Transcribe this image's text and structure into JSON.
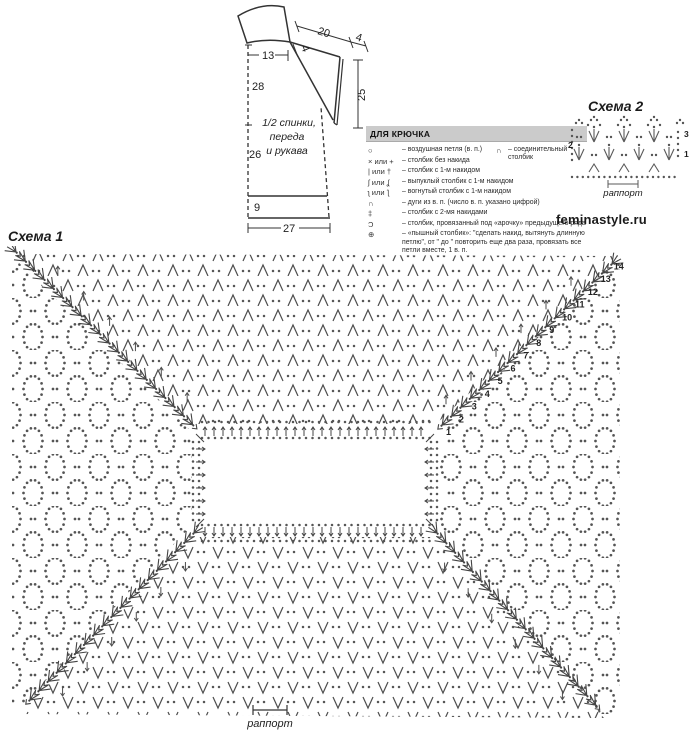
{
  "watermark": "feminastyle.ru",
  "schematic": {
    "label_line1": "1/2 спинки,",
    "label_line2": "переда",
    "label_line3": "и рукава",
    "dims": {
      "d13": "13",
      "d28": "28",
      "d26": "26",
      "d9": "9",
      "d27": "27",
      "d20": "20",
      "d4a": "4",
      "d4b": "4",
      "d25": "25"
    }
  },
  "legend": {
    "title": "ДЛЯ КРЮЧКА",
    "connector": {
      "symbol": "∩",
      "text": "– соединительный столбик"
    },
    "items": [
      {
        "symbol": "○",
        "text": "– воздушная петля (в. п.)"
      },
      {
        "symbol": "× или +",
        "text": "– столбик без накида"
      },
      {
        "symbol": "| или †",
        "text": "– столбик с 1-м накидом"
      },
      {
        "symbol": "ʃ или ʆ",
        "text": "– выпуклый столбик с 1-м накидом"
      },
      {
        "symbol": "ʅ или ƪ",
        "text": "– вогнутый столбик с 1-м накидом"
      },
      {
        "symbol": "∩",
        "text": "– дуги из в. п. (число в. п. указано цифрой)"
      },
      {
        "symbol": "‡",
        "text": "– столбик с 2-мя накидами"
      },
      {
        "symbol": "Ɔ",
        "text": "– столбик, провязанный под «арочку» предыдущего ряда"
      },
      {
        "symbol": "⊕",
        "text": "– «пышный столбик»: \"сделать накид, вытянуть длинную петлю\", от \" до \" повторить еще два раза, провязать все петли вместе, 1 в. п."
      }
    ]
  },
  "scheme2": {
    "title": "Схема 2",
    "row_number_left": "2",
    "row_number_right_top": "3",
    "row_number_right_bottom": "1",
    "repeat_label": "раппорт"
  },
  "scheme1": {
    "title": "Схема 1",
    "row_numbers": [
      "1",
      "2",
      "3",
      "4",
      "5",
      "6",
      "7",
      "8",
      "9",
      "10",
      "11",
      "12",
      "13",
      "14"
    ],
    "repeat_label": "раппорт"
  },
  "chart_data": [
    {
      "type": "crochet-chart",
      "name": "Схема 1",
      "construction": "square yoke worked in rounds outward from central rectangular neck opening",
      "raglan_row_numbers": [
        1,
        2,
        3,
        4,
        5,
        6,
        7,
        8,
        9,
        10,
        11,
        12,
        13,
        14
      ],
      "sectors": {
        "top": "V-stitch (галочки из столбиков) rows with chain dots",
        "bottom": "V-stitch rows with chain dots",
        "left": "openwork diamond mesh of chain arches",
        "right": "openwork diamond mesh of chain arches"
      },
      "raglan_lines": "four diagonal bands of puff-stitch leaf motifs from neck corners to outer corners",
      "repeat_label": "раппорт"
    },
    {
      "type": "crochet-chart",
      "name": "Схема 2",
      "rows": 3,
      "row_numbers_left": [
        2
      ],
      "row_numbers_right": [
        3,
        1
      ],
      "motifs": "fans of three double crochets alternating with chain-dot arches over a chain base",
      "repeat_label": "раппорт"
    }
  ]
}
